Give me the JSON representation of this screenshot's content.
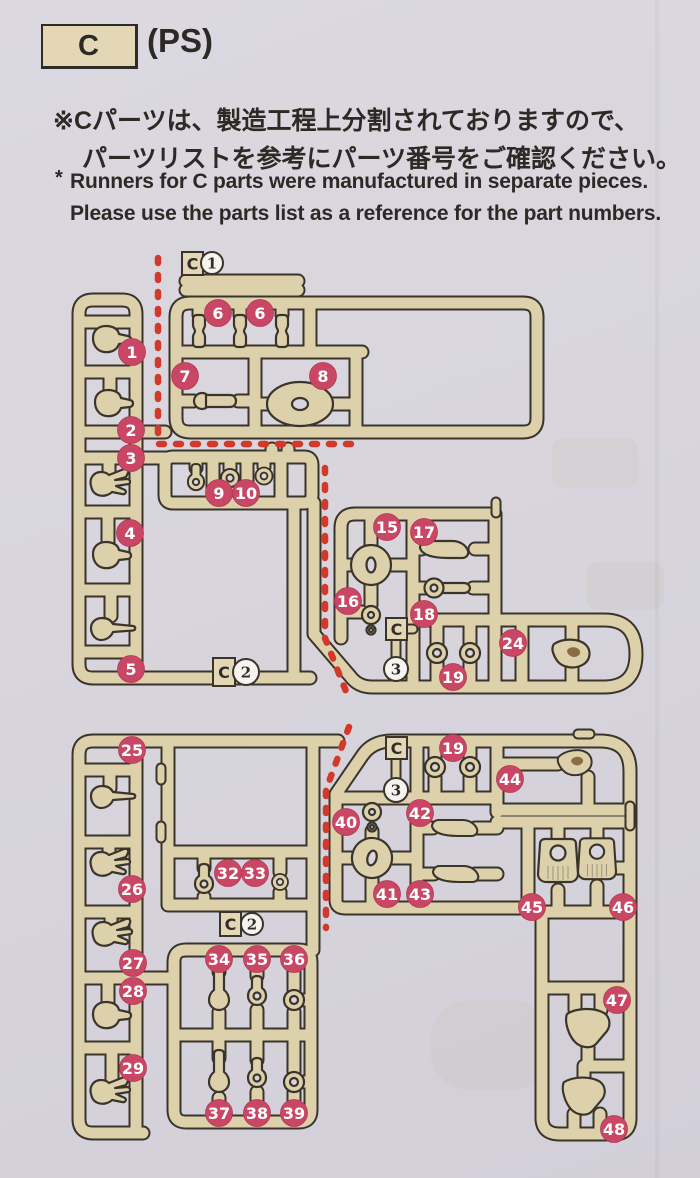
{
  "header": {
    "runner_letter": "C",
    "material_label": "(PS)",
    "note_jp_line1": "※Cパーツは、製造工程上分割されておりますので、",
    "note_jp_line2": "パーツリストを参考にパーツ番号をご確認ください。",
    "note_en_marker": "*",
    "note_en_line1": "Runners for C parts were manufactured in separate pieces.",
    "note_en_line2": "Please use the parts list as a reference for the part numbers."
  },
  "colors": {
    "page_bg": "#d8d5dd",
    "runner_fill": "#ddd1ac",
    "runner_outline": "#3a342b",
    "callout_red": "#c94764",
    "cut_line_red": "#d2392b",
    "tag_circle_fill": "#f6f4f0",
    "box_fill": "#e4d7b5",
    "text": "#2d2a26"
  },
  "diagram": {
    "callouts": [
      {
        "label": "1",
        "x": 132,
        "y": 352
      },
      {
        "label": "2",
        "x": 131,
        "y": 430
      },
      {
        "label": "3",
        "x": 131,
        "y": 458
      },
      {
        "label": "4",
        "x": 130,
        "y": 533
      },
      {
        "label": "5",
        "x": 131,
        "y": 669
      },
      {
        "label": "6",
        "x": 218,
        "y": 313
      },
      {
        "label": "6",
        "x": 260,
        "y": 313
      },
      {
        "label": "7",
        "x": 185,
        "y": 376
      },
      {
        "label": "8",
        "x": 323,
        "y": 376
      },
      {
        "label": "9",
        "x": 219,
        "y": 493
      },
      {
        "label": "10",
        "x": 246,
        "y": 493
      },
      {
        "label": "15",
        "x": 387,
        "y": 527
      },
      {
        "label": "17",
        "x": 424,
        "y": 532
      },
      {
        "label": "16",
        "x": 348,
        "y": 601
      },
      {
        "label": "18",
        "x": 424,
        "y": 614
      },
      {
        "label": "24",
        "x": 513,
        "y": 643
      },
      {
        "label": "19",
        "x": 453,
        "y": 677
      },
      {
        "label": "25",
        "x": 132,
        "y": 750
      },
      {
        "label": "26",
        "x": 132,
        "y": 889
      },
      {
        "label": "27",
        "x": 133,
        "y": 963
      },
      {
        "label": "28",
        "x": 133,
        "y": 991
      },
      {
        "label": "29",
        "x": 133,
        "y": 1068
      },
      {
        "label": "32",
        "x": 228,
        "y": 873
      },
      {
        "label": "33",
        "x": 255,
        "y": 873
      },
      {
        "label": "34",
        "x": 219,
        "y": 959
      },
      {
        "label": "35",
        "x": 257,
        "y": 959
      },
      {
        "label": "36",
        "x": 294,
        "y": 959
      },
      {
        "label": "37",
        "x": 219,
        "y": 1113
      },
      {
        "label": "38",
        "x": 257,
        "y": 1113
      },
      {
        "label": "39",
        "x": 294,
        "y": 1113
      },
      {
        "label": "19",
        "x": 453,
        "y": 748
      },
      {
        "label": "44",
        "x": 510,
        "y": 779
      },
      {
        "label": "40",
        "x": 346,
        "y": 822
      },
      {
        "label": "42",
        "x": 420,
        "y": 813
      },
      {
        "label": "41",
        "x": 387,
        "y": 894
      },
      {
        "label": "43",
        "x": 420,
        "y": 894
      },
      {
        "label": "45",
        "x": 532,
        "y": 907
      },
      {
        "label": "46",
        "x": 623,
        "y": 907
      },
      {
        "label": "47",
        "x": 617,
        "y": 1000
      },
      {
        "label": "48",
        "x": 614,
        "y": 1129
      }
    ],
    "tags": [
      {
        "letter": "C",
        "number": "1",
        "box": [
          182,
          252,
          21,
          23
        ],
        "circle": [
          212,
          263,
          11
        ]
      },
      {
        "letter": "C",
        "number": "2",
        "box": [
          213,
          658,
          22,
          28
        ],
        "circle": [
          246,
          672,
          13
        ]
      },
      {
        "letter": "C",
        "number": "3",
        "box": [
          386,
          618,
          21,
          22
        ],
        "circle": [
          396,
          669,
          12
        ]
      },
      {
        "letter": "C",
        "number": "2",
        "box": [
          220,
          912,
          21,
          24
        ],
        "circle": [
          252,
          924,
          11
        ]
      },
      {
        "letter": "C",
        "number": "3",
        "box": [
          386,
          737,
          21,
          22
        ],
        "circle": [
          396,
          790,
          12
        ]
      }
    ]
  }
}
